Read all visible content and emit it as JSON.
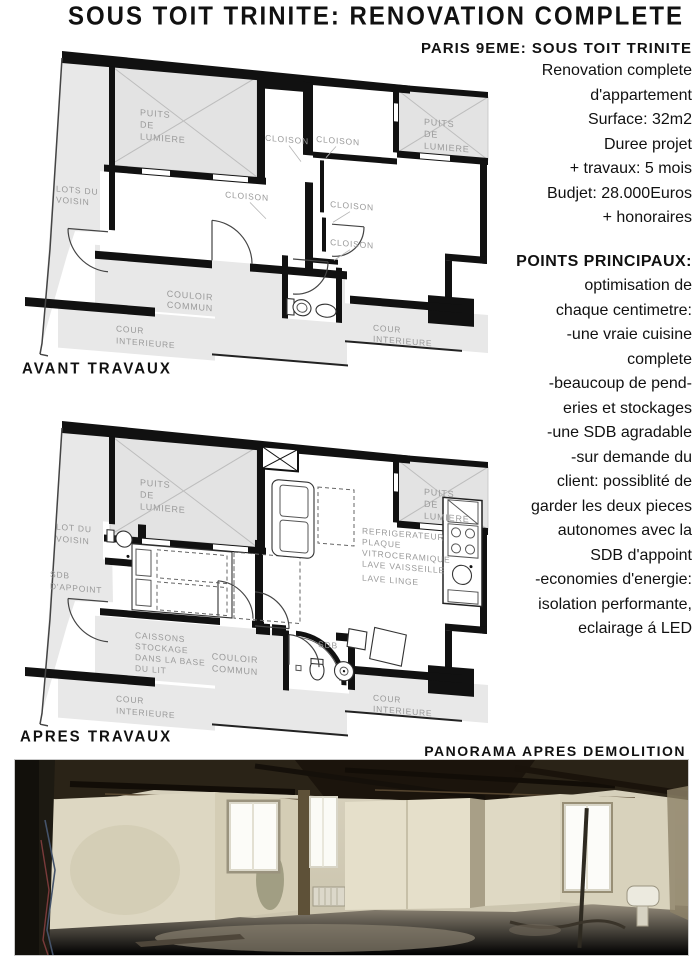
{
  "title": "SOUS TOIT TRINITE: RENOVATION COMPLETE",
  "sidebar": {
    "heading": "PARIS 9EME: SOUS TOIT TRINITE",
    "intro": [
      "Renovation complete",
      "d'appartement",
      "Surface: 32m2",
      "Duree projet",
      "+ travaux: 5 mois",
      "Budjet: 28.000Euros",
      "+ honoraires"
    ],
    "points_heading": "POINTS PRINCIPAUX:",
    "points": [
      "optimisation de",
      "chaque centimetre:",
      "-une vraie cuisine",
      "complete",
      "-beaucoup de pend-",
      "eries et stockages",
      "-une SDB agradable",
      "-sur demande du",
      "client: possiblité de",
      "garder les deux pieces",
      "autonomes avec la",
      "SDB d'appoint",
      "-economies d'energie:",
      "isolation performante,",
      "eclairage á LED"
    ]
  },
  "plans": {
    "before": {
      "caption": "AVANT TRAVAUX",
      "labels": {
        "puits": [
          "PUITS",
          "DE",
          "LUMIERE"
        ],
        "lots_voisin": [
          "LOTS DU",
          "VOISIN"
        ],
        "cloison": "CLOISON",
        "couloir": [
          "COULOIR",
          "COMMUN"
        ],
        "cour": [
          "COUR",
          "INTERIEURE"
        ]
      }
    },
    "after": {
      "caption": "APRES TRAVAUX",
      "labels": {
        "puits": [
          "PUITS",
          "DE",
          "LUMIERE"
        ],
        "lot_voisin": [
          "LOT DU",
          "VOISIN"
        ],
        "sdb_appoint": [
          "SDB",
          "D'APPOINT"
        ],
        "caissons": [
          "CAISSONS",
          "STOCKAGE",
          "DANS LA BASE",
          "DU LIT"
        ],
        "couloir": [
          "COULOIR",
          "COMMUN"
        ],
        "kitchen": [
          "REFRIGERATEUR",
          "PLAQUE",
          "VITROCERAMIQUE",
          "LAVE VAISSEILLE"
        ],
        "lave_linge": "LAVE LINGE",
        "sdb": "SDB",
        "cour": [
          "COUR",
          "INTERIEURE"
        ]
      }
    }
  },
  "panorama": {
    "heading": "PANORAMA APRES DEMOLITION"
  },
  "colors": {
    "wall_black": "#111111",
    "plan_grey": "#e8e8e8",
    "label_grey": "#9a9a9a",
    "page_bg": "#ffffff"
  }
}
